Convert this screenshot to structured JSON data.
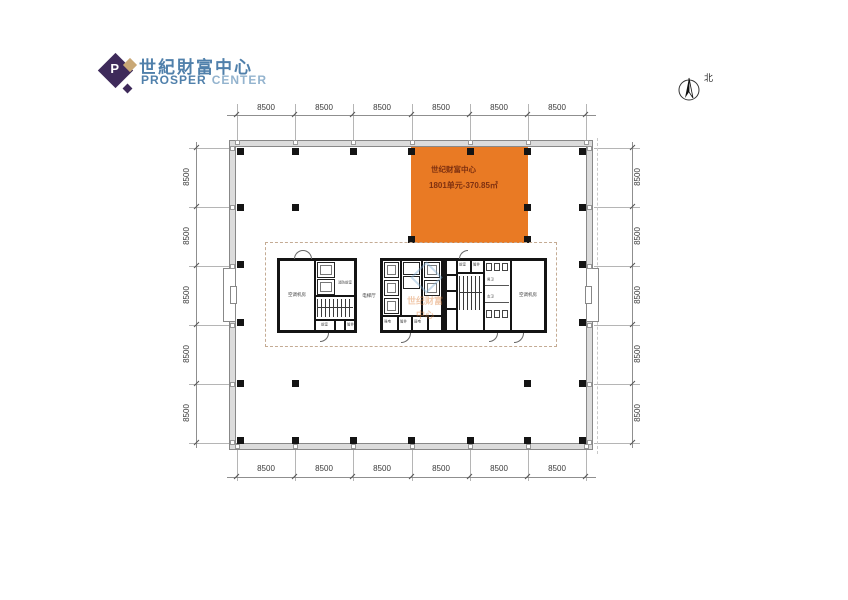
{
  "logo": {
    "title_cn": "世紀財富中心",
    "en_1": "PROSPER",
    "en_2": "CENTER",
    "diamond_color": "#3E2A5A",
    "accent_color": "#C9A876",
    "text_blue": "#5080AB"
  },
  "north": {
    "label": "北"
  },
  "unit": {
    "project": "世纪财富中心",
    "detail": "1801单元-370.85㎡",
    "fill_color": "#E97A24",
    "text_color": "#7E3010"
  },
  "dims": {
    "top": [
      "8500",
      "8500",
      "8500",
      "8500",
      "8500",
      "8500"
    ],
    "bottom": [
      "8500",
      "8500",
      "8500",
      "8500",
      "8500",
      "8500"
    ],
    "left": [
      "8500",
      "8500",
      "8500",
      "8500",
      "8500"
    ],
    "right": [
      "8500",
      "8500",
      "8500",
      "8500",
      "8500"
    ]
  },
  "core": {
    "elevator_hall": "电梯厅",
    "left_block": {
      "ac_room": "空调机房",
      "fire_lobby": "消防前室",
      "lobby": "前室",
      "shaft": "管井"
    },
    "mid_block": {
      "strong_power": "强电",
      "shaft": "管井",
      "weak_power": "弱电"
    },
    "right_block": {
      "ac_room": "空调机房",
      "male_wc": "男卫",
      "female_wc": "女卫",
      "lobby": "前室",
      "shaft": "管井"
    }
  },
  "watermark": {
    "line1": "世纪财富",
    "line2": "中心"
  }
}
